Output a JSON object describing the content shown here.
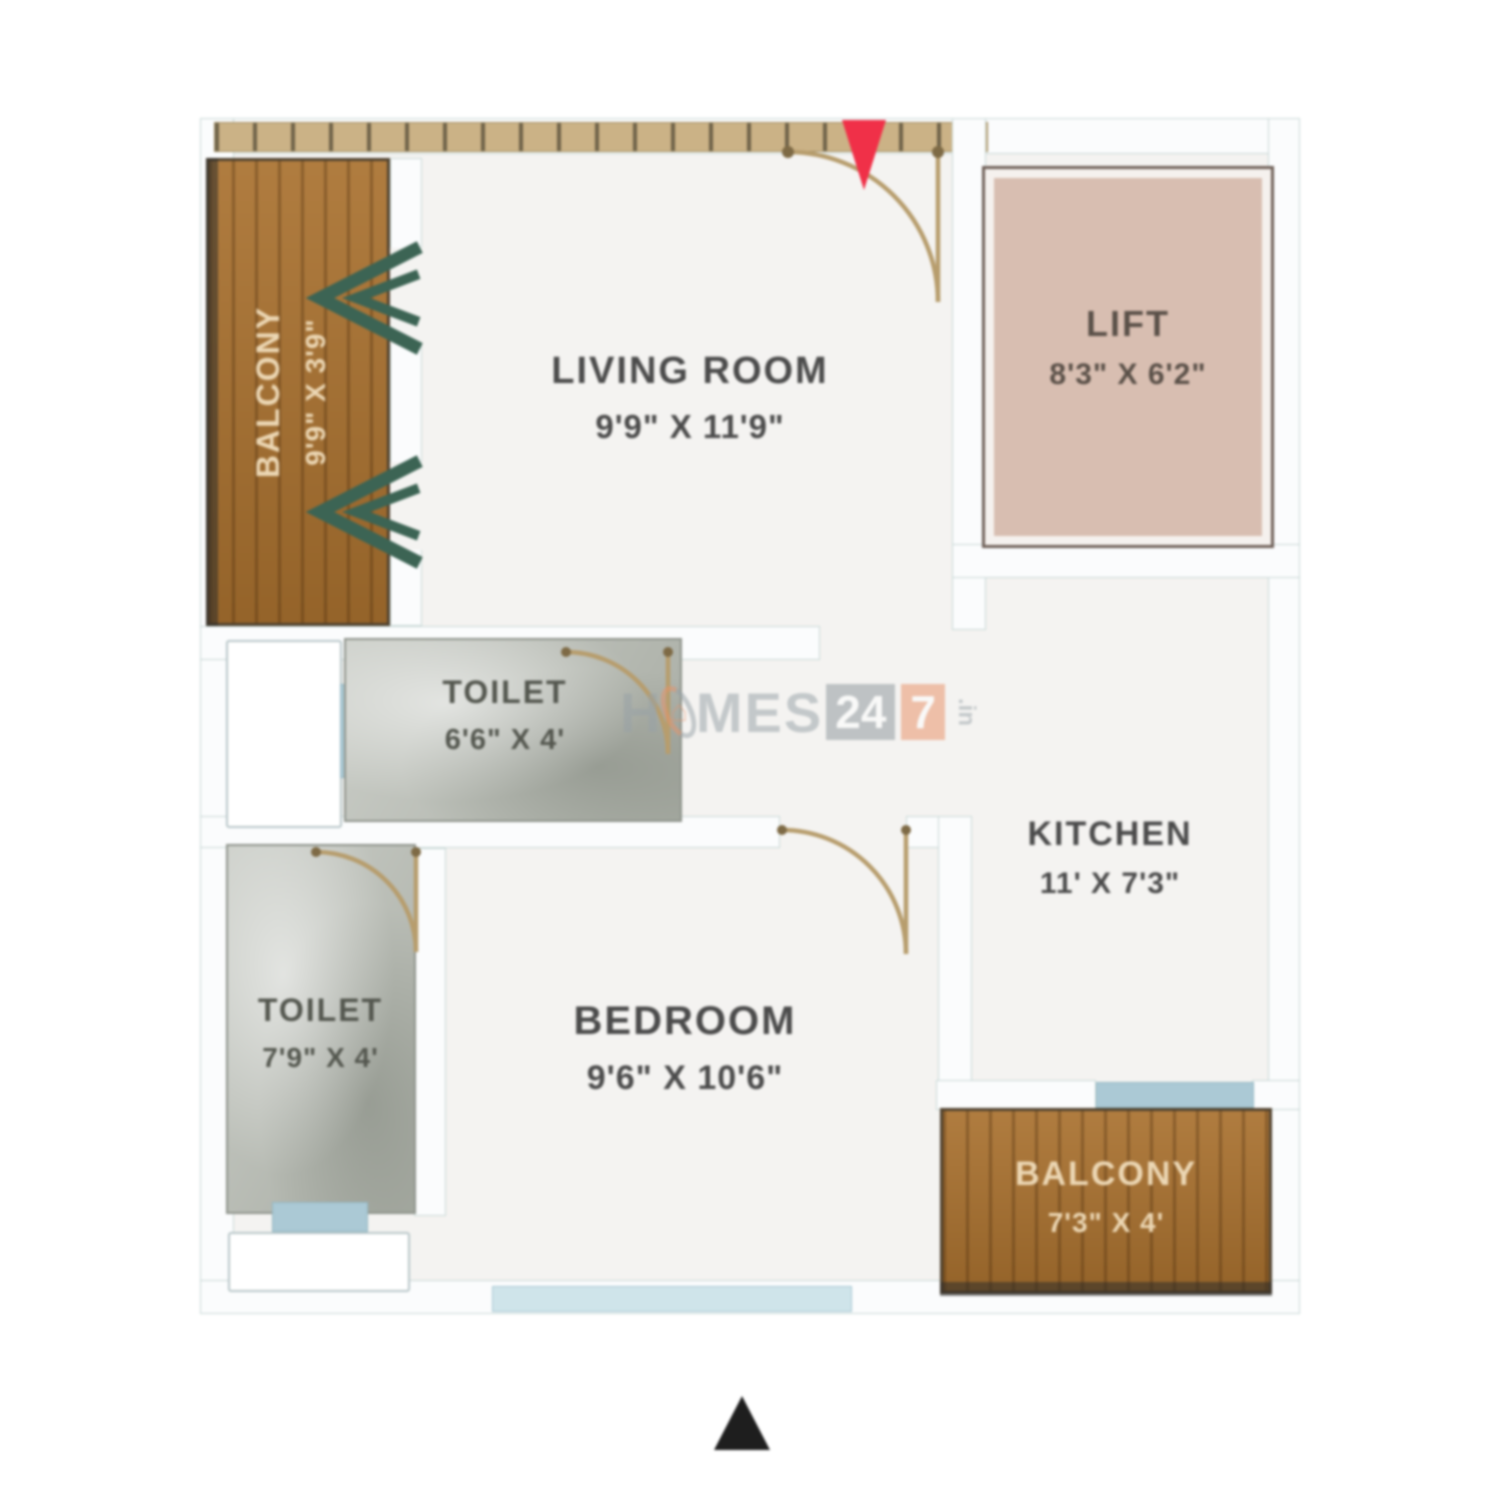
{
  "title": "1 BHK Apartment Floor Plan",
  "rooms": {
    "living": {
      "name": "LIVING ROOM",
      "dims": "9'9\" X 11'9\""
    },
    "lift": {
      "name": "LIFT",
      "dims": "8'3\" X 6'2\""
    },
    "toilet1": {
      "name": "TOILET",
      "dims": "6'6\" X 4'"
    },
    "toilet2": {
      "name": "TOILET",
      "dims": "7'9\" X 4'"
    },
    "kitchen": {
      "name": "KITCHEN",
      "dims": "11' X 7'3\""
    },
    "bedroom": {
      "name": "BEDROOM",
      "dims": "9'6\" X 10'6\""
    },
    "balcony1": {
      "name": "BALCONY",
      "dims": "9'9\" X 3'9\""
    },
    "balcony2": {
      "name": "BALCONY",
      "dims": "7'3\" X 4'"
    }
  },
  "watermark": {
    "part1": "H",
    "part2": "MES",
    "badge1": "24",
    "badge2": "7",
    "suffix": ".in"
  },
  "icons": {
    "entrance_arrow": "red down arrow marking main entrance",
    "north_arrow": "black up triangle at bottom",
    "balcony_chevrons": "green double chevrons at balcony openings"
  },
  "colors": {
    "wood": "#a9712f",
    "lift_fill": "#d8beb1",
    "marble": "#b9bdb5",
    "floor": "#f4f3f1",
    "wall": "#fbfcfd",
    "door_arc": "#b79d6d",
    "entrance_arrow": "#f03048",
    "chevron_green": "#3c6454",
    "window_blue": "#abc9d5",
    "watermark_gray": "#98a2a7",
    "watermark_orange": "#ea9066"
  }
}
